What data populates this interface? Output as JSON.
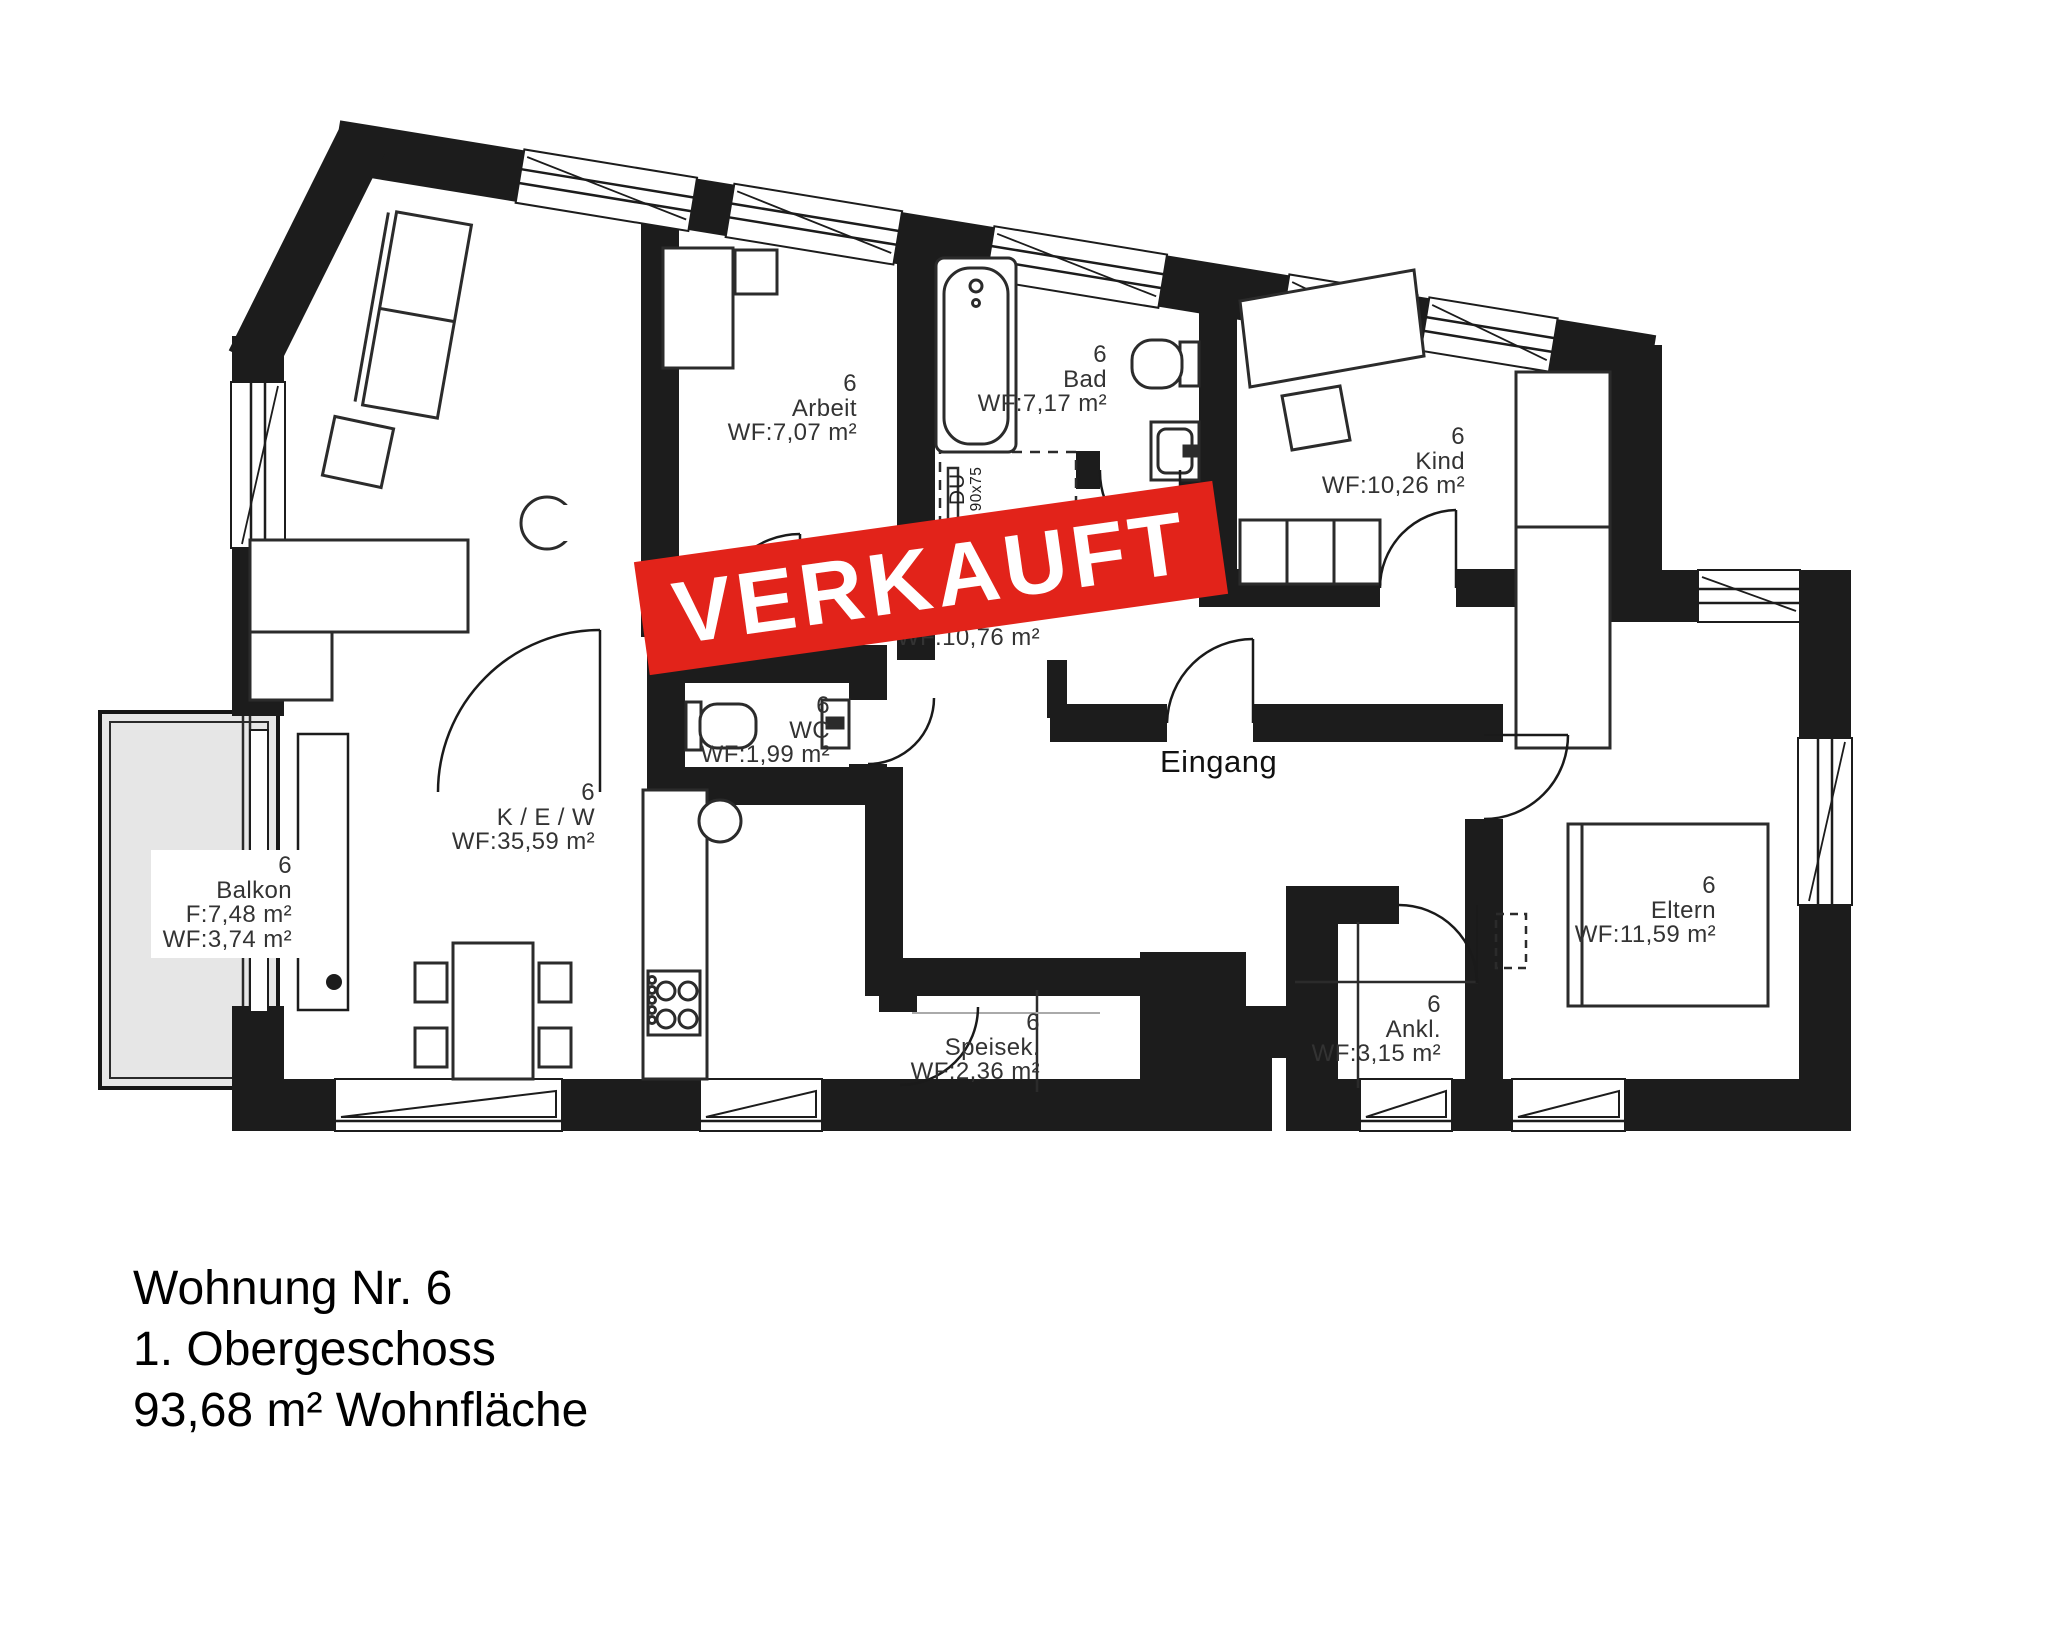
{
  "title_block": {
    "line1": "Wohnung Nr. 6",
    "line2": "1. Obergeschoss",
    "line3": "93,68 m² Wohnfläche"
  },
  "banner": {
    "text": "VERKAUFT",
    "bg_color": "#e2231a",
    "text_color": "#ffffff"
  },
  "entrance_label": "Eingang",
  "shower_label": {
    "type": "DU",
    "size": "90x75"
  },
  "hallway_area_label": "WF:10,76 m²",
  "apartment_number": "6",
  "rooms": [
    {
      "id": "arbeit",
      "number": "6",
      "name": "Arbeit",
      "area": "WF:7,07 m²"
    },
    {
      "id": "bad",
      "number": "6",
      "name": "Bad",
      "area": "WF:7,17 m²"
    },
    {
      "id": "kind",
      "number": "6",
      "name": "Kind",
      "area": "WF:10,26 m²"
    },
    {
      "id": "wc",
      "number": "6",
      "name": "WC",
      "area": "WF:1,99 m²"
    },
    {
      "id": "kew",
      "number": "6",
      "name": "K / E / W",
      "area": "WF:35,59 m²"
    },
    {
      "id": "balkon",
      "number": "6",
      "name": "Balkon",
      "area": "F:7,48 m²",
      "area2": "WF:3,74 m²"
    },
    {
      "id": "eltern",
      "number": "6",
      "name": "Eltern",
      "area": "WF:11,59 m²"
    },
    {
      "id": "ankleide",
      "number": "6",
      "name": "Ankl.",
      "area": "WF:3,15 m²"
    },
    {
      "id": "speisekammer",
      "number": "6",
      "name": "Speisek.",
      "area": "WF:2,36 m²"
    }
  ],
  "colors": {
    "wall": "#1c1c1c",
    "balcony_fill": "#e6e6e6",
    "banner_red": "#e2231a",
    "label_text": "#333333"
  }
}
